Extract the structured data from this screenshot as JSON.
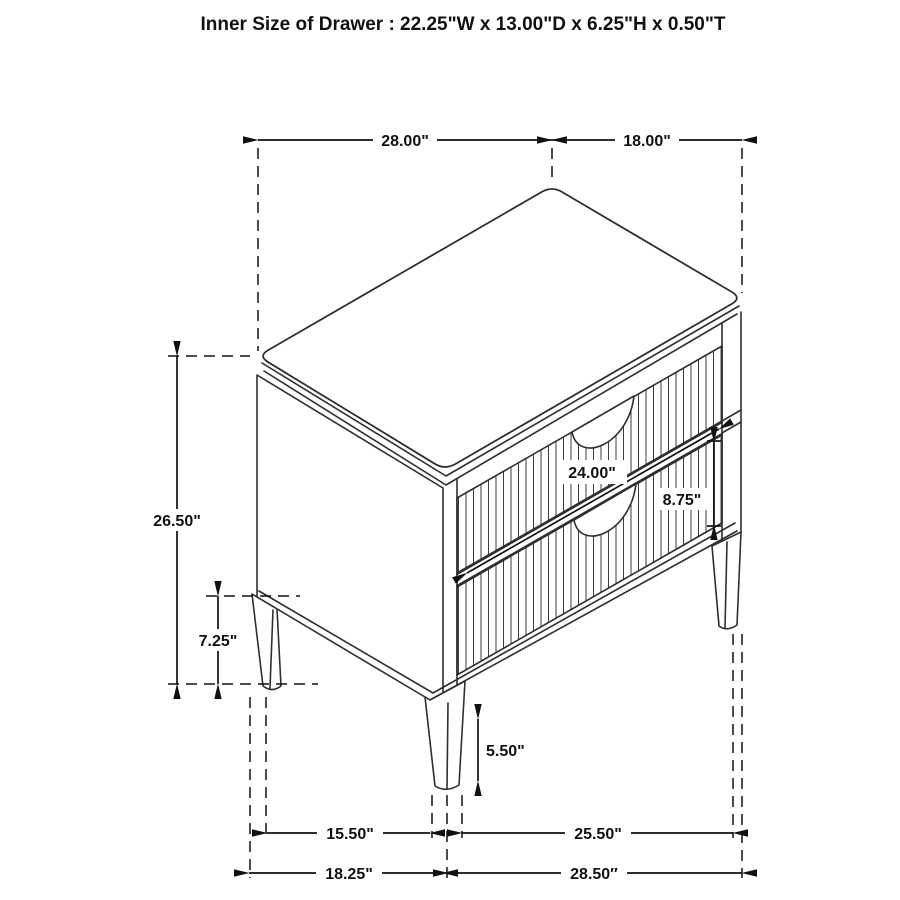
{
  "title": "Inner Size of Drawer : 22.25\"W x 13.00\"D x 6.25\"H x 0.50\"T",
  "dimensions": {
    "top_width": "28.00\"",
    "top_depth": "18.00\"",
    "overall_height": "26.50\"",
    "base_height": "7.25\"",
    "drawer_opening_width": "24.00\"",
    "drawer_front_height": "8.75\"",
    "leg_height": "5.50\"",
    "leg_span_depth": "15.50\"",
    "leg_span_width": "25.50\"",
    "floor_depth": "18.25\"",
    "floor_width": "28.50″"
  },
  "colors": {
    "background": "#ffffff",
    "furniture_line": "#2f2f2f",
    "dimension_line": "#111111"
  }
}
